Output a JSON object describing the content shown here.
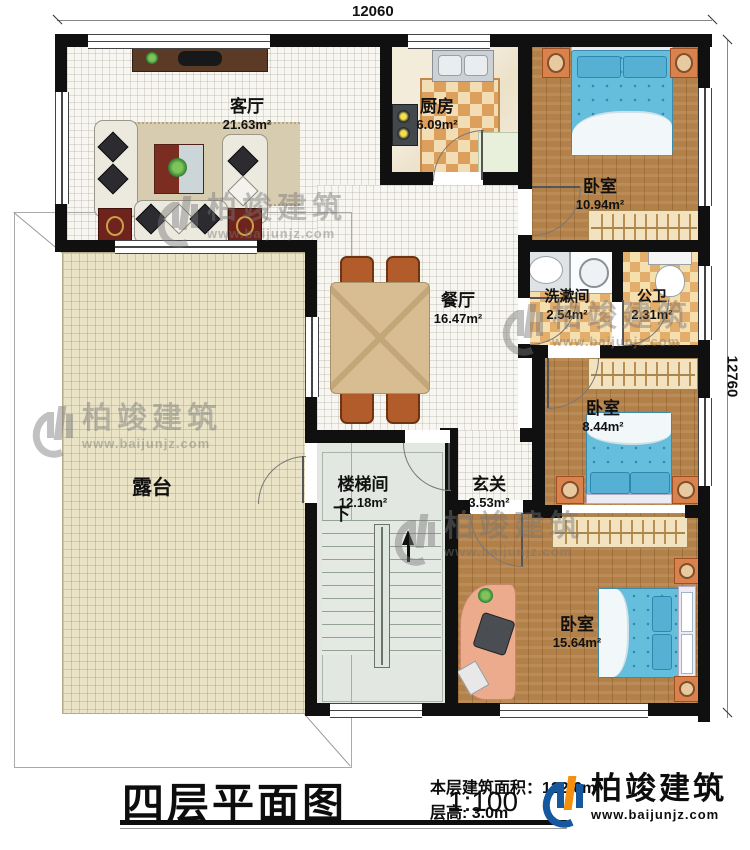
{
  "dimensions": {
    "top": "12060",
    "right": "12760"
  },
  "rooms": {
    "living": {
      "name": "客厅",
      "area": "21.63m²"
    },
    "kitchen": {
      "name": "厨房",
      "area": "6.09m²"
    },
    "bedroom1": {
      "name": "卧室",
      "area": "10.94m²"
    },
    "dining": {
      "name": "餐厅",
      "area": "16.47m²"
    },
    "washroom": {
      "name": "洗漱间",
      "area": "2.54m²"
    },
    "toilet": {
      "name": "公卫",
      "area": "2.31m²"
    },
    "bedroom2": {
      "name": "卧室",
      "area": "8.44m²"
    },
    "terrace": {
      "name": "露台"
    },
    "stairwell": {
      "name": "楼梯间",
      "area": "12.18m²"
    },
    "foyer": {
      "name": "玄关",
      "area": "3.53m²"
    },
    "bedroom3": {
      "name": "卧室",
      "area": "15.64m²"
    }
  },
  "stairs": {
    "direction_label": "下"
  },
  "titleblock": {
    "title": "四层平面图",
    "scale": "1:100",
    "area_line": "本层建筑面积：122.6m²",
    "floor_height_line": "层高: 3.0m"
  },
  "brand": {
    "name": "柏竣建筑",
    "url": "www.baijunjz.com"
  },
  "watermark": {
    "name": "柏竣建筑",
    "url": "www.baijunjz.com"
  },
  "colors": {
    "wall": "#101010",
    "bed": "#66bedd",
    "wood": "#b28049",
    "brand_blue": "#1558a0",
    "brand_orange": "#f5900f"
  }
}
